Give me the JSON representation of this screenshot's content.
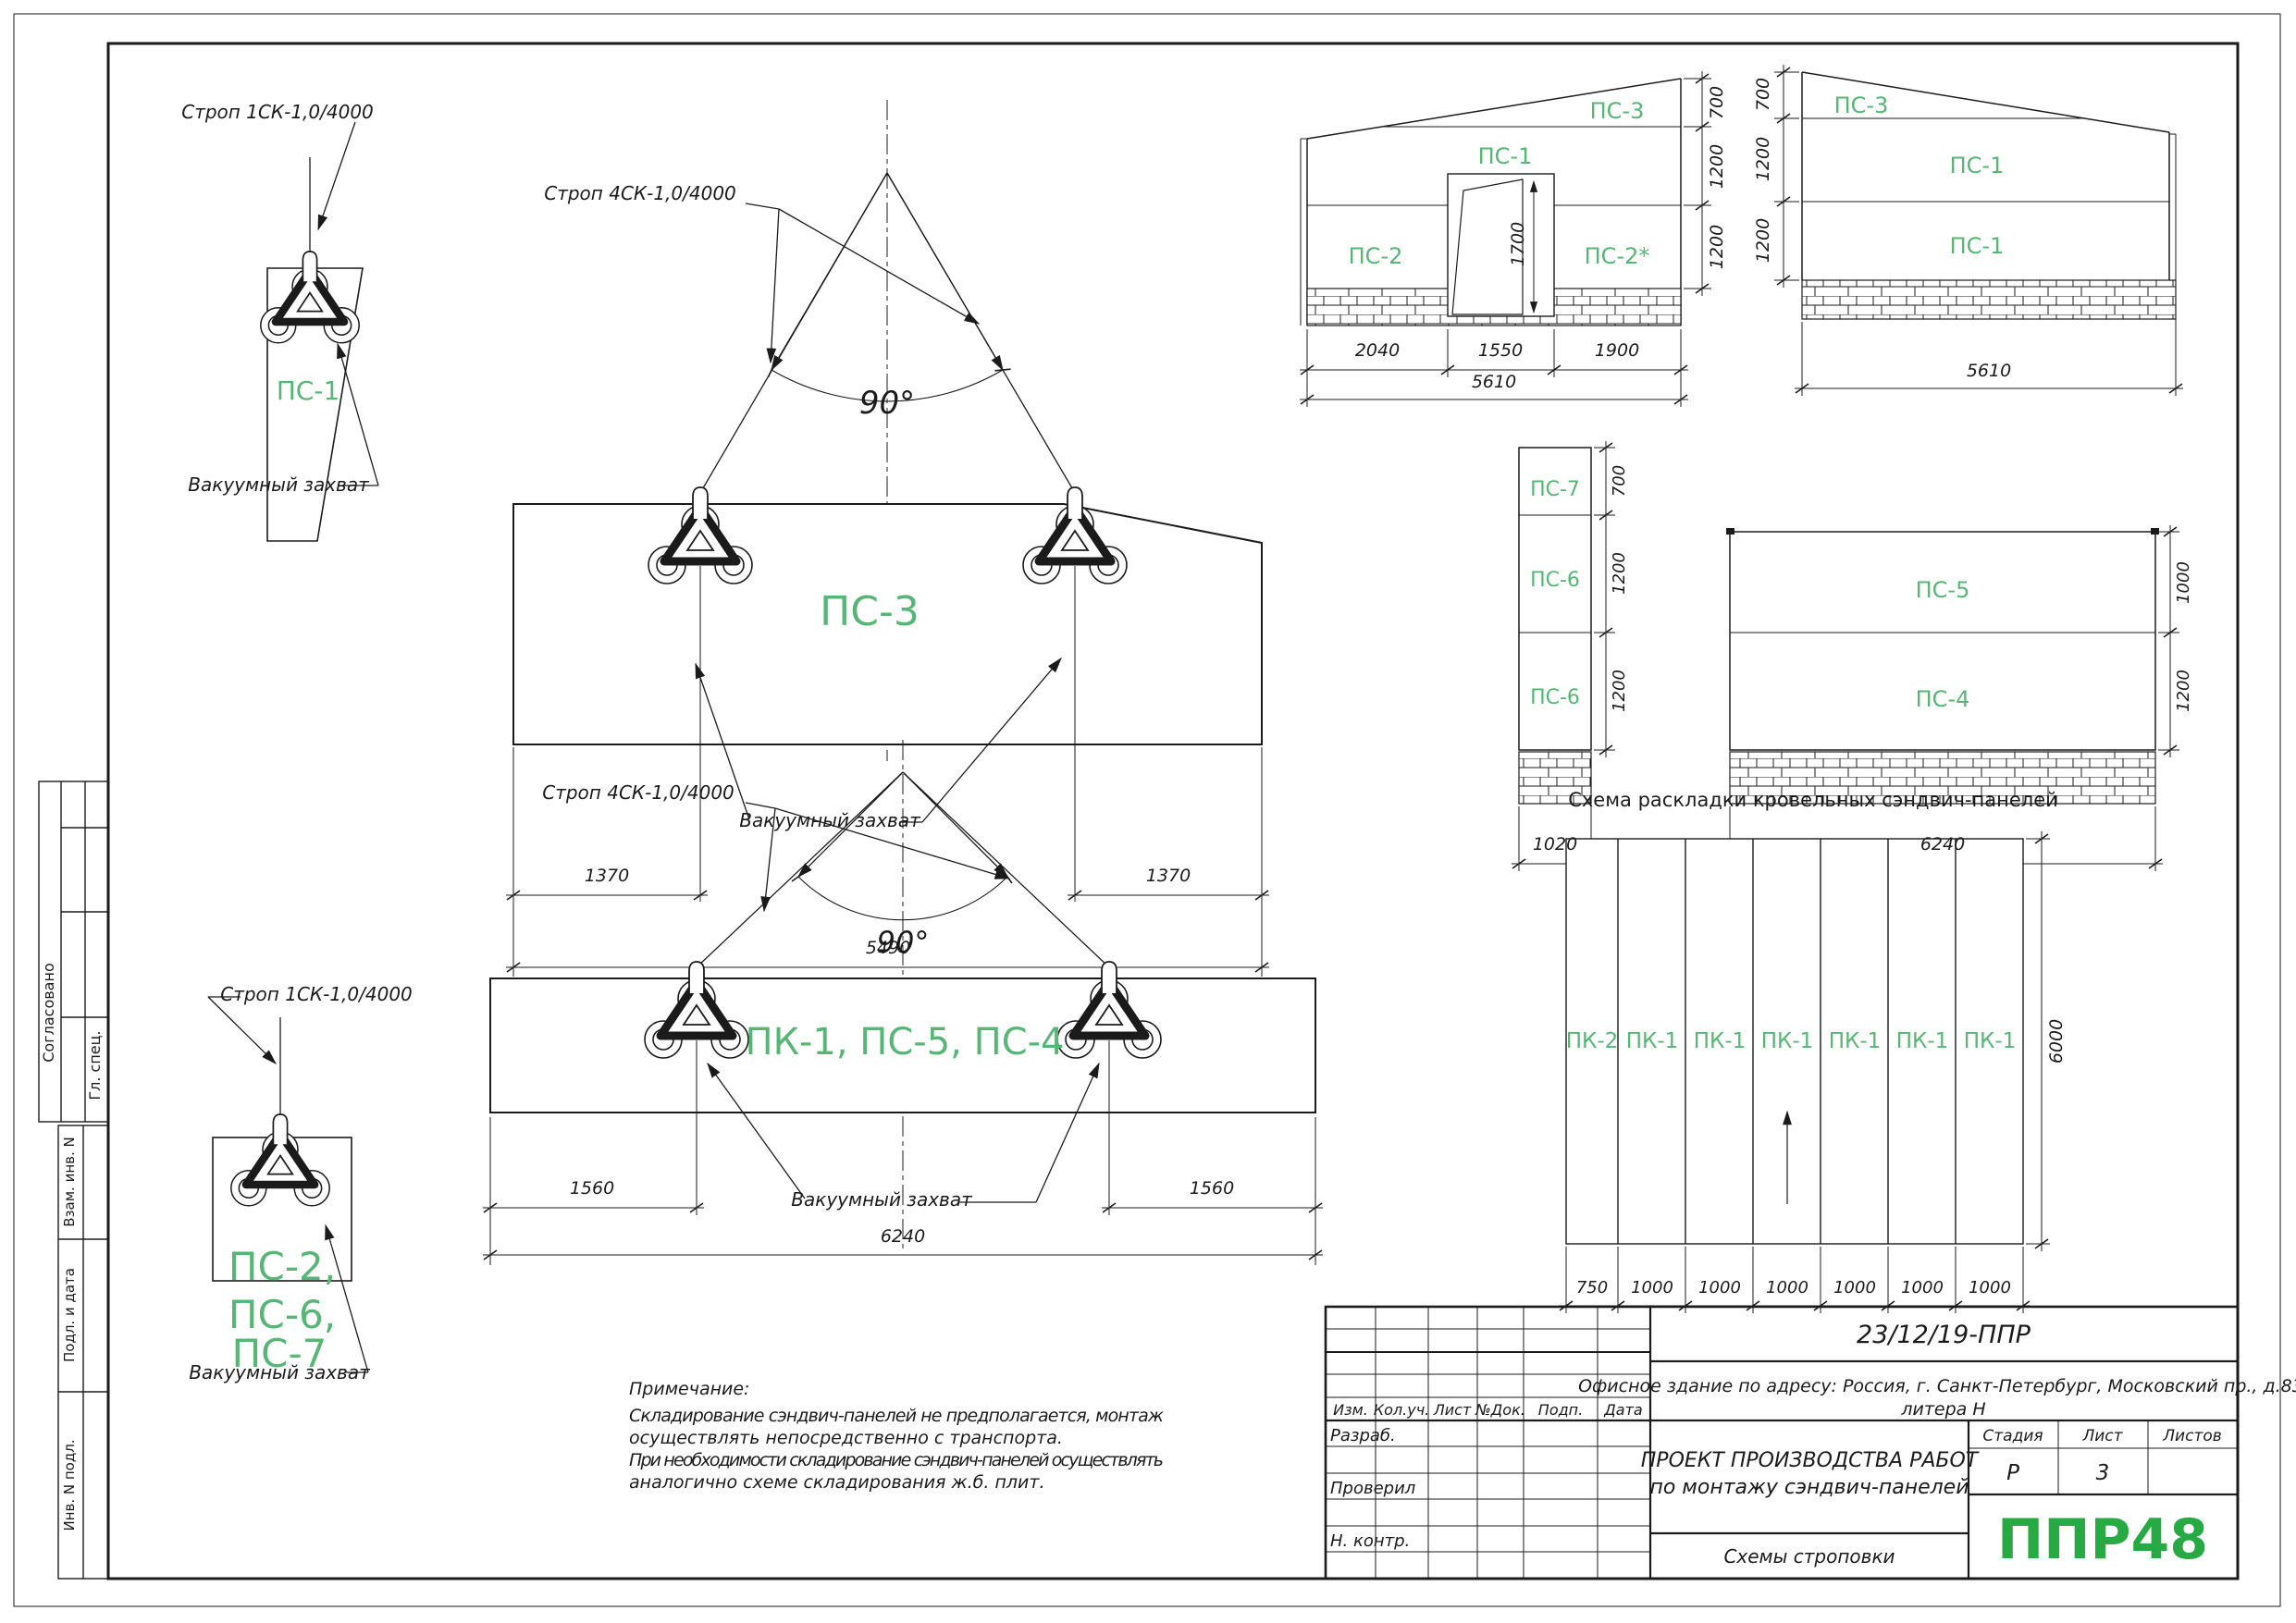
{
  "colors": {
    "label_green": "#57b576",
    "logo_green": "#27aa44",
    "line": "#1b1b1b"
  },
  "side_stamps": {
    "soglasovano": "Согласовано",
    "gl_spec": "Гл. спец.",
    "vzam_inv": "Взам. инв. N",
    "podl_data": "Подл. и дата",
    "inv_podl": "Инв. N подл."
  },
  "schemes": {
    "single_top": {
      "sling": "Строп 1СК-1,0/4000",
      "panel": "ПС-1",
      "grip_label": "Вакуумный захват"
    },
    "ps3": {
      "sling": "Строп 4СК-1,0/4000",
      "angle": "90°",
      "panel": "ПС-3",
      "grip_label": "Вакуумный захват",
      "dim_left": "1370",
      "dim_right": "1370",
      "dim_total": "5490"
    },
    "pk1": {
      "sling": "Строп 4СК-1,0/4000",
      "angle": "90°",
      "panel": "ПК-1, ПС-5, ПС-4",
      "grip_label": "Вакуумный захват",
      "dim_left": "1560",
      "dim_right": "1560",
      "dim_total": "6240"
    },
    "single_bottom": {
      "sling": "Строп 1СК-1,0/4000",
      "panel_lines": [
        "ПС-2,",
        "ПС-6,",
        "ПС-7"
      ],
      "grip_label": "Вакуумный захват"
    }
  },
  "elevations": {
    "front_left": {
      "labels": [
        "ПС-3",
        "ПС-1",
        "ПС-2",
        "ПС-2*"
      ],
      "door_height": "1700",
      "heights": [
        "700",
        "1200",
        "1200"
      ],
      "widths": [
        "2040",
        "1550",
        "1900"
      ],
      "total_width": "5610"
    },
    "front_right": {
      "labels": [
        "ПС-3",
        "ПС-1",
        "ПС-1"
      ],
      "heights": [
        "700",
        "1200",
        "1200"
      ],
      "total_width": "5610"
    },
    "side_column": {
      "labels": [
        "ПС-7",
        "ПС-6",
        "ПС-6"
      ],
      "heights": [
        "700",
        "1200",
        "1200"
      ],
      "total_width": "1020"
    },
    "side_wall": {
      "labels": [
        "ПС-5",
        "ПС-4"
      ],
      "heights": [
        "1000",
        "1200"
      ],
      "total_width": "6240"
    }
  },
  "roof_layout": {
    "title": "Схема раскладки кровельных сэндвич-панелей",
    "panels": [
      "ПК-2",
      "ПК-1",
      "ПК-1",
      "ПК-1",
      "ПК-1",
      "ПК-1",
      "ПК-1"
    ],
    "widths": [
      "750",
      "1000",
      "1000",
      "1000",
      "1000",
      "1000",
      "1000"
    ],
    "depth": "6000"
  },
  "notes": {
    "heading": "Примечание:",
    "lines": [
      "Складирование  сэндвич-панелей  не  предполагается,  монтаж",
      "осуществлять непосредственно с транспорта.",
      "При  необходимости  складирование  сэндвич-панелей  осуществлять",
      "аналогично схеме складирования ж.б. плит."
    ]
  },
  "title_block": {
    "doc_number": "23/12/19-ППР",
    "address_line1": "Офисное здание по адресу: Россия, г. Санкт-Петербург, Московский пр., д.83,",
    "address_line2": "литера Н",
    "header_cols": [
      "Изм.",
      "Кол.уч.",
      "Лист",
      "№Док.",
      "Подп.",
      "Дата"
    ],
    "row_labels": [
      "Разраб.",
      "Проверил",
      "Н. контр."
    ],
    "project_title_line1": "ПРОЕКТ ПРОИЗВОДСТВА РАБОТ",
    "project_title_line2": "по монтажу сэндвич-панелей",
    "stage_label": "Стадия",
    "sheet_label": "Лист",
    "sheets_label": "Листов",
    "stage_value": "Р",
    "sheet_value": "3",
    "sheet_title": "Схемы строповки",
    "logo": "ППР48"
  }
}
